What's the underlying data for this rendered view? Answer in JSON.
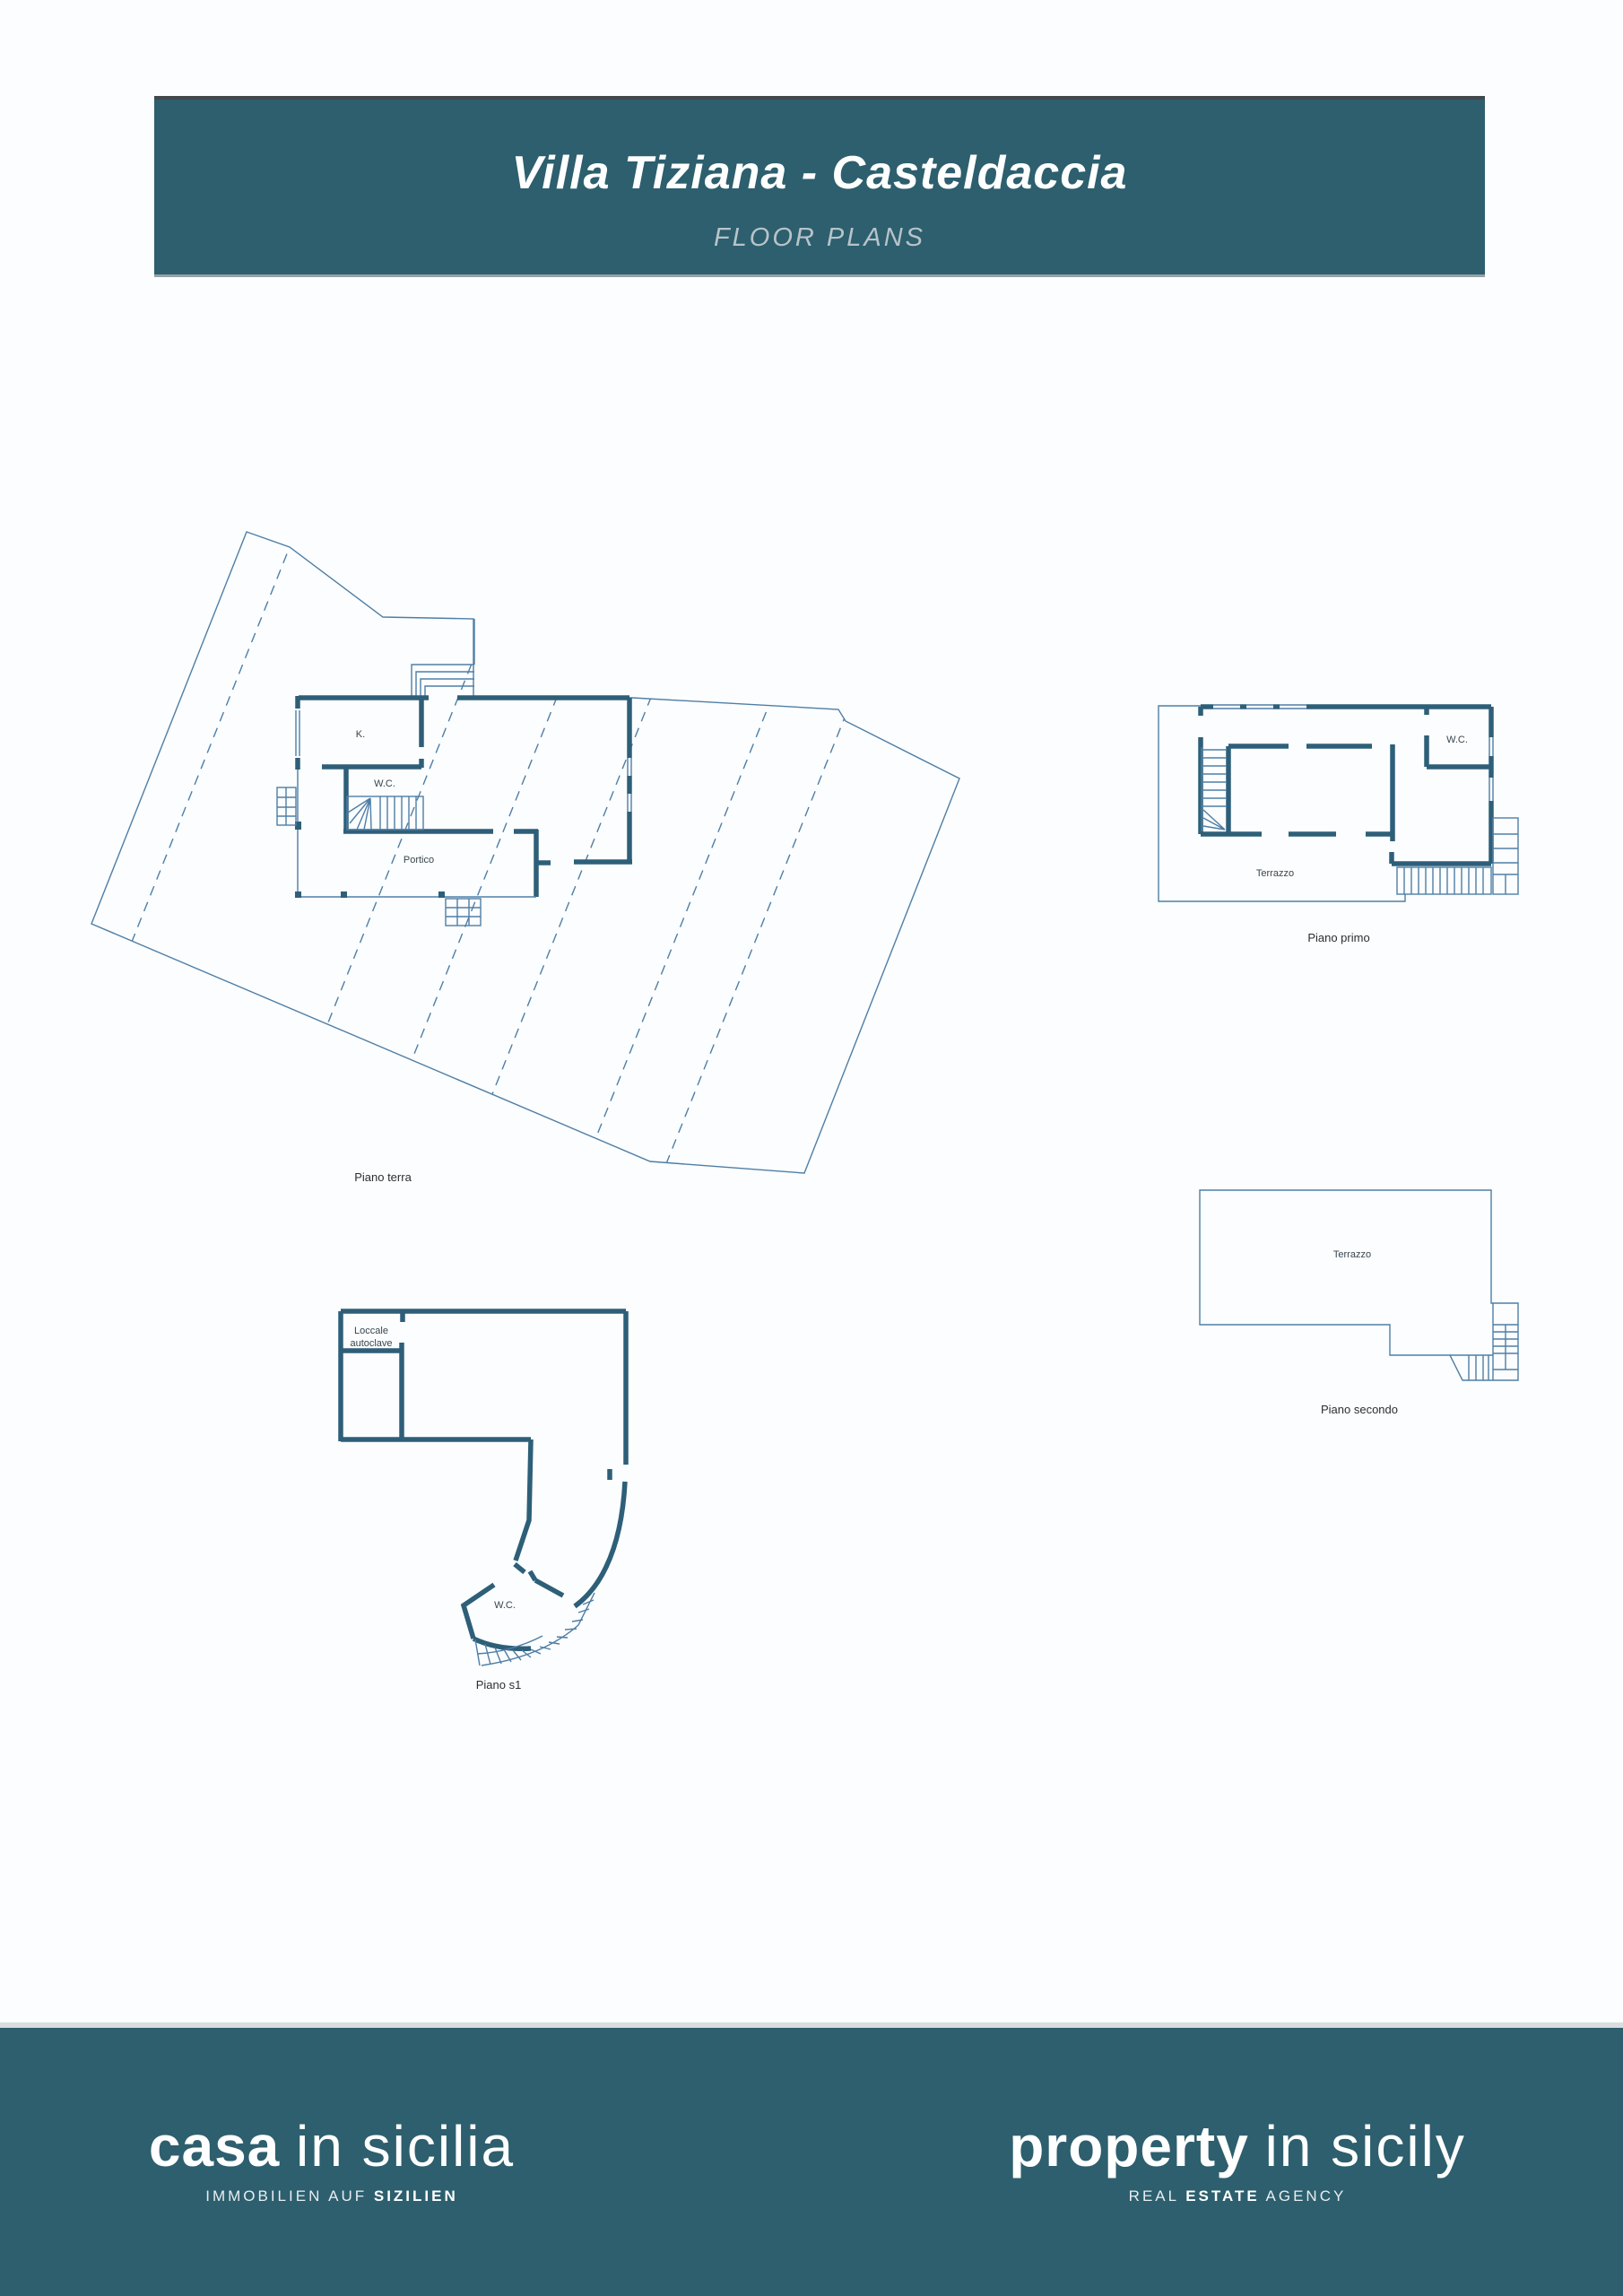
{
  "header": {
    "title": "Villa Tiziana - Casteldaccia",
    "subtitle": "FLOOR PLANS"
  },
  "plans": {
    "terra": {
      "caption": "Piano terra",
      "label_k": "K.",
      "label_wc": "W.C.",
      "label_portico": "Portico"
    },
    "primo": {
      "caption": "Piano primo",
      "label_wc": "W.C.",
      "label_terrazzo": "Terrazzo"
    },
    "secondo": {
      "caption": "Piano secondo",
      "label_terrazzo": "Terrazzo"
    },
    "s1": {
      "caption": "Piano s1",
      "label_room_line1": "Loccale",
      "label_room_line2": "autoclave",
      "label_wc": "W.C."
    }
  },
  "footer": {
    "casa": {
      "brand_bold": "casa",
      "brand_light": "in sicilia",
      "tagline_light": "IMMOBILIEN AUF ",
      "tagline_bold": "SIZILIEN"
    },
    "property": {
      "brand_bold": "property",
      "brand_light": "in sicily",
      "tagline_pre": "REAL ",
      "tagline_bold": "ESTATE",
      "tagline_post": " AGENCY"
    }
  },
  "colors": {
    "header_bg": "#2d5f6e",
    "footer_bg": "#2d5f6e",
    "wall": "#2e5f78",
    "thin_line": "#4f7ea6",
    "page_bg": "#fbfdfe"
  }
}
